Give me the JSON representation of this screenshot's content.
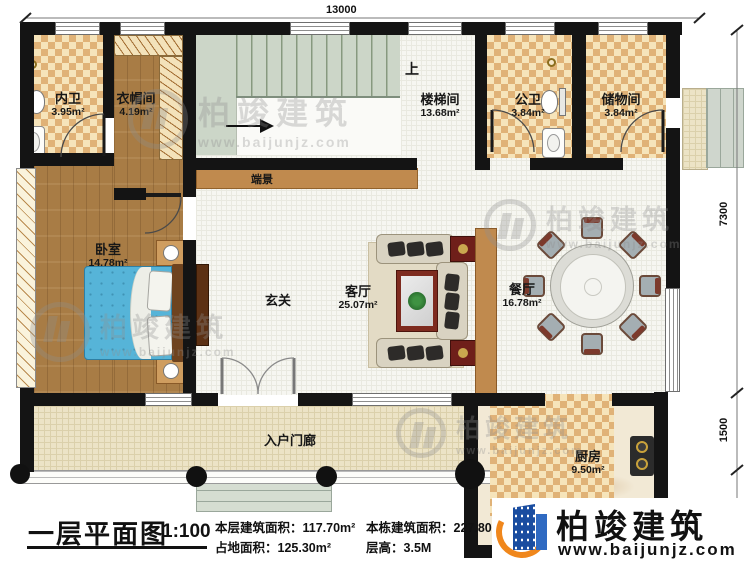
{
  "plan": {
    "dim_top": "13000",
    "dim_right": [
      "7300",
      "1500",
      "500"
    ],
    "rooms": {
      "neiwei": {
        "name": "内卫",
        "area": "3.95m²"
      },
      "yimaojian": {
        "name": "衣帽间",
        "area": "4.19m²"
      },
      "loutijian": {
        "name": "楼梯间",
        "area": "13.68m²"
      },
      "gongwei": {
        "name": "公卫",
        "area": "3.84m²"
      },
      "chuwujian": {
        "name": "储物间",
        "area": "3.84m²"
      },
      "woshi": {
        "name": "卧室",
        "area": "14.78m²"
      },
      "keting": {
        "name": "客厅",
        "area": "25.07m²"
      },
      "canting": {
        "name": "餐厅",
        "area": "16.78m²"
      },
      "chufang": {
        "name": "厨房",
        "area": "9.50m²"
      }
    },
    "labels": {
      "xuanguan": "玄关",
      "porch": "入户门廊",
      "duanjing": "端景",
      "stairs_up": "上"
    }
  },
  "title_block": {
    "title": "一层平面图",
    "scale": "1:100",
    "stats": [
      {
        "label": "本层建筑面积：",
        "value": "117.70m²"
      },
      {
        "label": "本栋建筑面积：",
        "value": "227.80m²"
      },
      {
        "label": "占地面积：",
        "value": "125.30m²"
      },
      {
        "label": "层高：",
        "value": "3.5M"
      }
    ]
  },
  "branding": {
    "logo_name": "柏竣建筑",
    "logo_url": "www.baijunjz.com",
    "watermark_name": "柏竣建筑",
    "watermark_url": "www.baijunjz.com"
  },
  "colors": {
    "wall": "#141414",
    "accent_blue": "#1a4da0",
    "accent_orange": "#f0871c",
    "bed_blue": "#56b4d8",
    "checker_dark": "#e0b277",
    "wood": "#a87c45"
  }
}
